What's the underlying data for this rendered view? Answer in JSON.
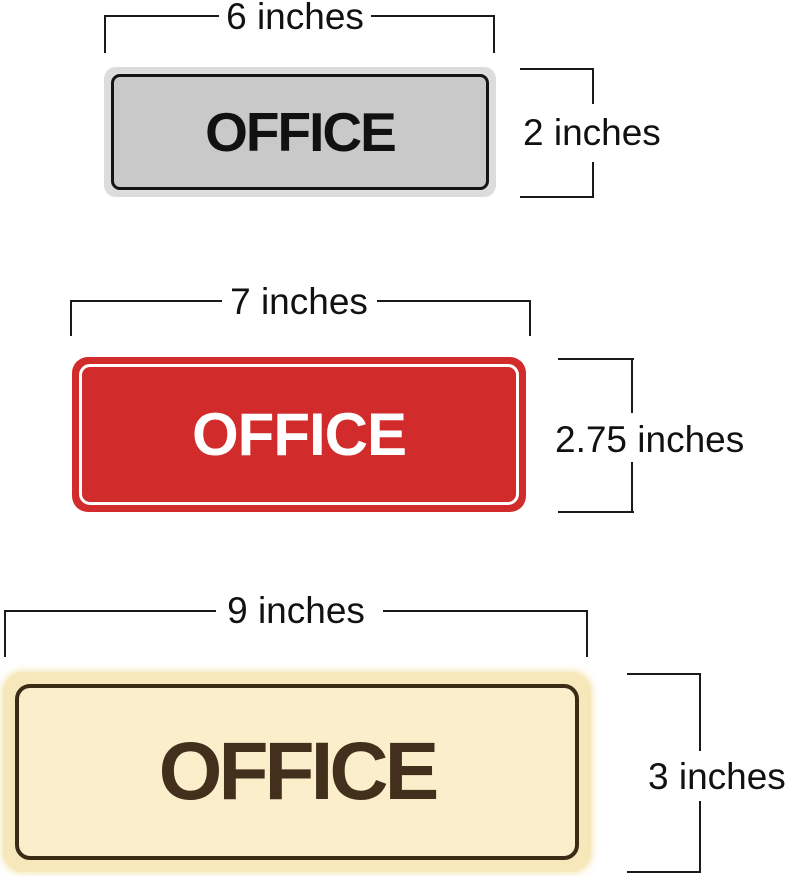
{
  "page": {
    "background": "#ffffff",
    "dimension_line_color": "#1a1a1a"
  },
  "signs": [
    {
      "name": "gray-office-sign",
      "label": "OFFICE",
      "width_label": "6 inches",
      "height_label": "2 inches",
      "colors": {
        "face": "#c9c9c9",
        "rim": "#dcdcdc",
        "border": "#141414",
        "text": "#111111"
      }
    },
    {
      "name": "red-office-sign",
      "label": "OFFICE",
      "width_label": "7 inches",
      "height_label": "2.75 inches",
      "colors": {
        "face": "#d12b2b",
        "rim": "#d12b2b",
        "border": "#ffffff",
        "text": "#ffffff"
      }
    },
    {
      "name": "cream-office-sign",
      "label": "OFFICE",
      "width_label": "9 inches",
      "height_label": "3 inches",
      "colors": {
        "face": "#faeecb",
        "rim": "#f6e8bb",
        "border": "#3a2b16",
        "text": "#43301c"
      }
    }
  ]
}
